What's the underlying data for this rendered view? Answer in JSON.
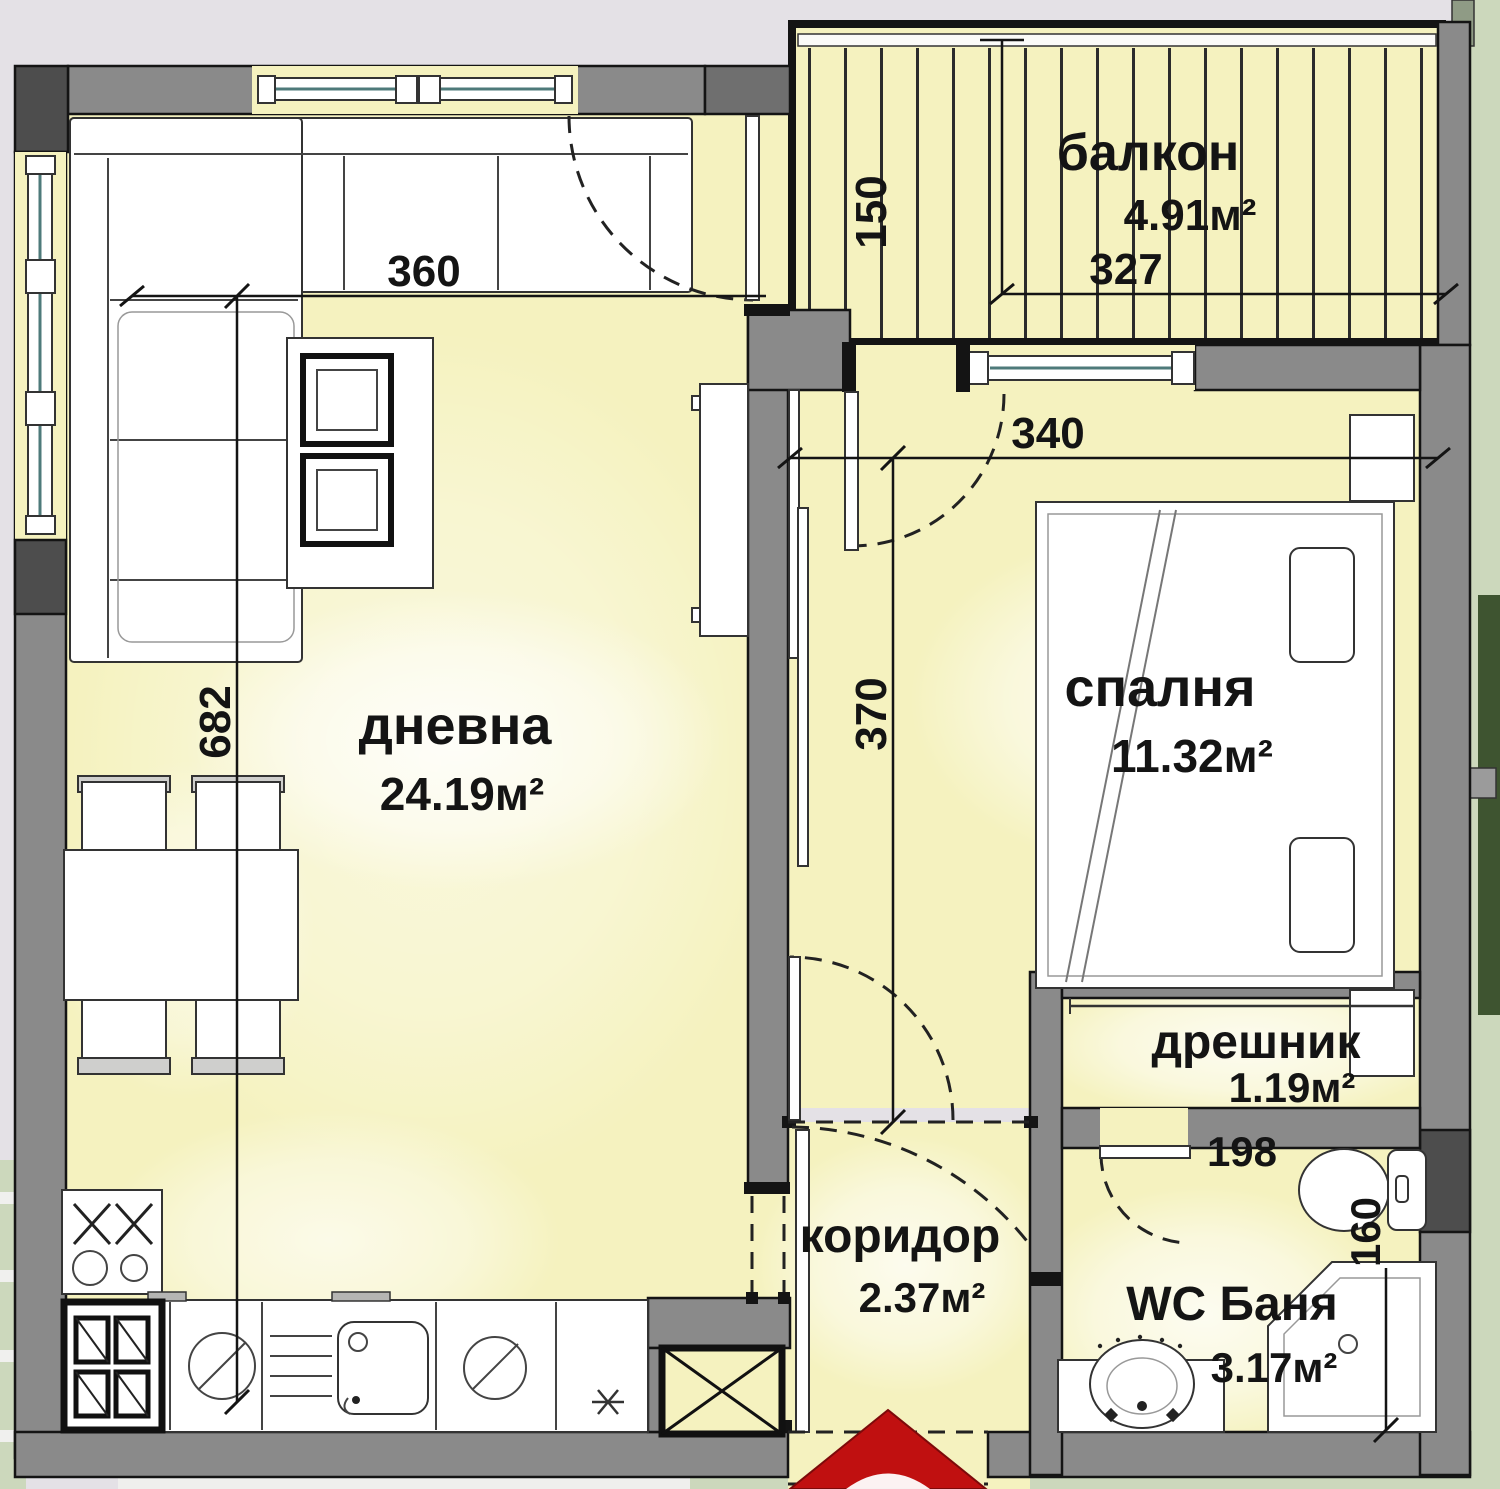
{
  "plan": {
    "rooms": [
      {
        "name": "дневна",
        "area": "24.19м²"
      },
      {
        "name": "спалня",
        "area": "11.32м²"
      },
      {
        "name": "балкон",
        "area": "4.91м²"
      },
      {
        "name": "дрешник",
        "area": "1.19м²"
      },
      {
        "name": "коридор",
        "area": "2.37м²"
      },
      {
        "name": "WC Баня",
        "area": "3.17м²"
      }
    ],
    "dimensions": {
      "living_width": "360",
      "living_height": "682",
      "balcony_depth": "150",
      "balcony_width": "327",
      "bedroom_width": "340",
      "bedroom_height": "370",
      "bath_width": "198",
      "bath_height": "160"
    },
    "colors": {
      "floor": "#f5f2bf",
      "wall": "#8a8a8a",
      "wall_dark": "#4d4d4d",
      "outline": "#141414",
      "window": "#4e7a7a",
      "background": "#e4e1e6",
      "green": "#ccd8bc",
      "green_dark": "#3e5430",
      "entrance_arrow": "#c01010"
    }
  }
}
